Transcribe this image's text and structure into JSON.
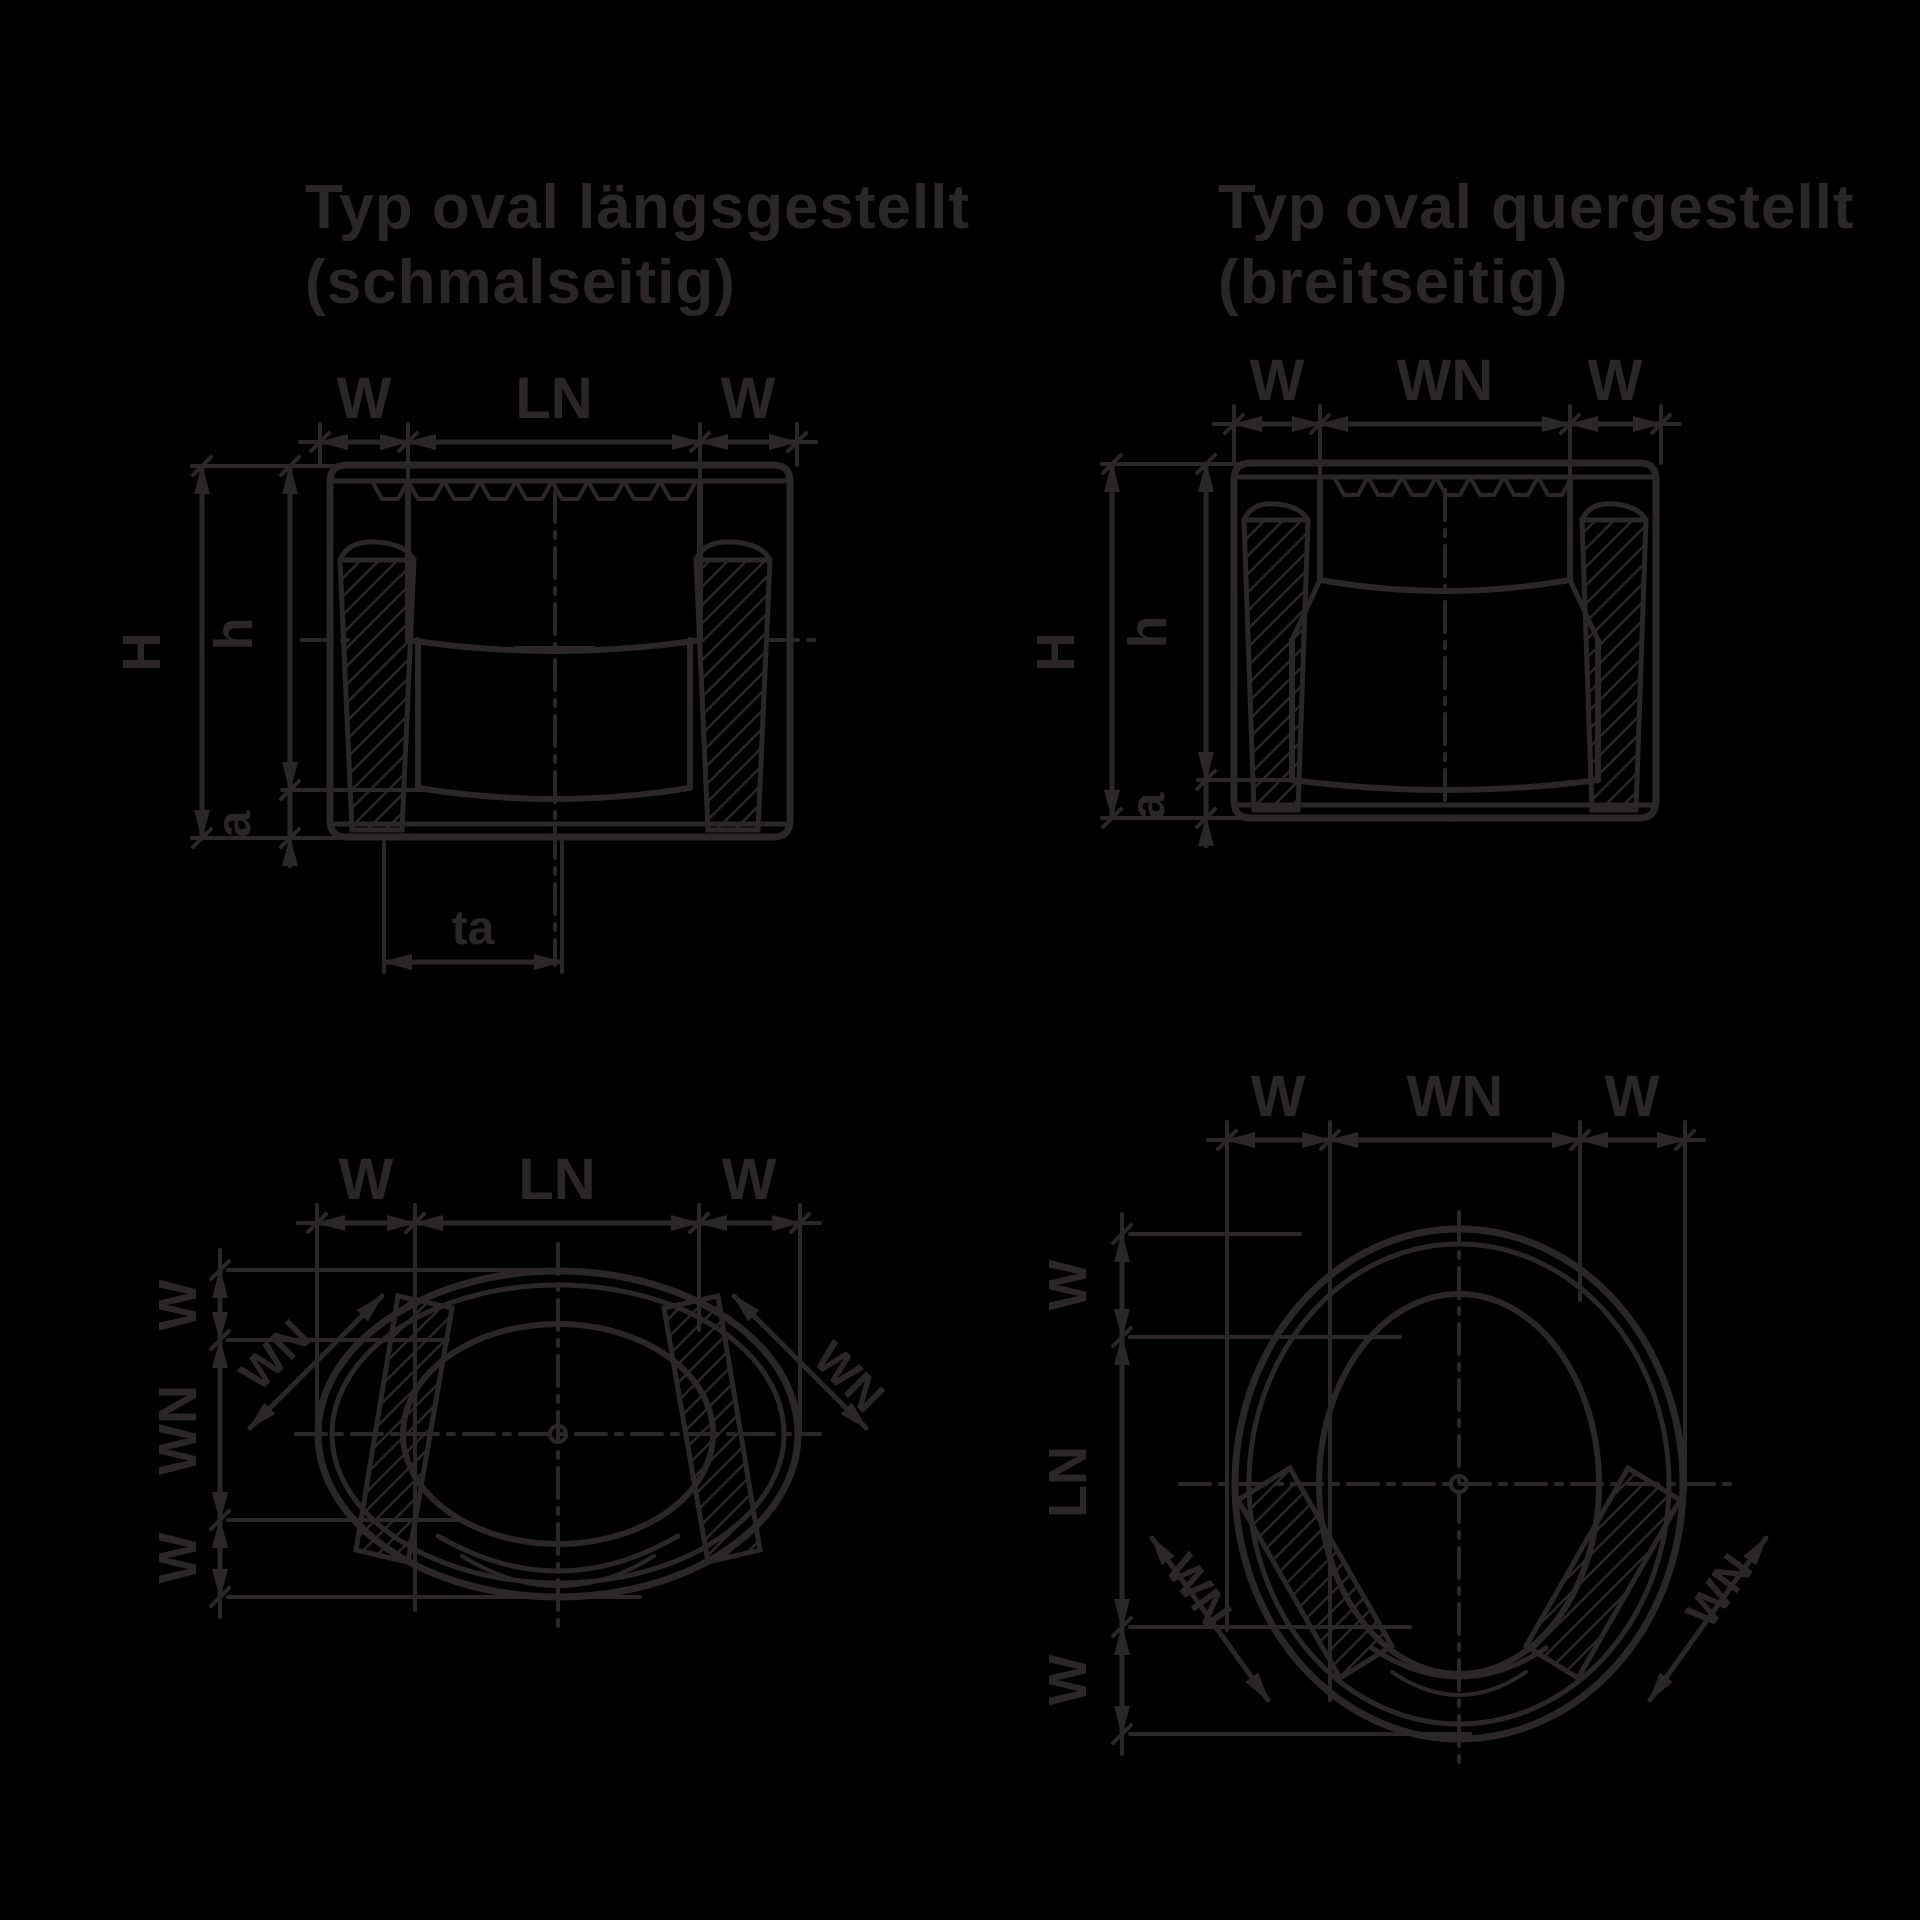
{
  "colors": {
    "background": "#000000",
    "line": "#2b2628"
  },
  "d1": {
    "title1": "Typ oval längsgestellt",
    "title2": "(schmalseitig)",
    "top": [
      "W",
      "LN",
      "W"
    ],
    "height_total": "H",
    "height_inner": "h",
    "clearance": "a",
    "stand_width": "ta"
  },
  "d2": {
    "title1": "Typ oval quergestellt",
    "title2": "(breitseitig)",
    "top": [
      "W",
      "WN",
      "W"
    ],
    "height_total": "H",
    "height_inner": "h",
    "clearance": "a"
  },
  "d3": {
    "top": [
      "W",
      "LN",
      "W"
    ],
    "left": [
      "W",
      "WN",
      "W"
    ],
    "diag_left": "WN",
    "diag_right": "WN"
  },
  "d4": {
    "top": [
      "W",
      "WN",
      "W"
    ],
    "left": [
      "W",
      "LN",
      "W"
    ],
    "diag_left": "WN",
    "diag_right": "WN"
  }
}
